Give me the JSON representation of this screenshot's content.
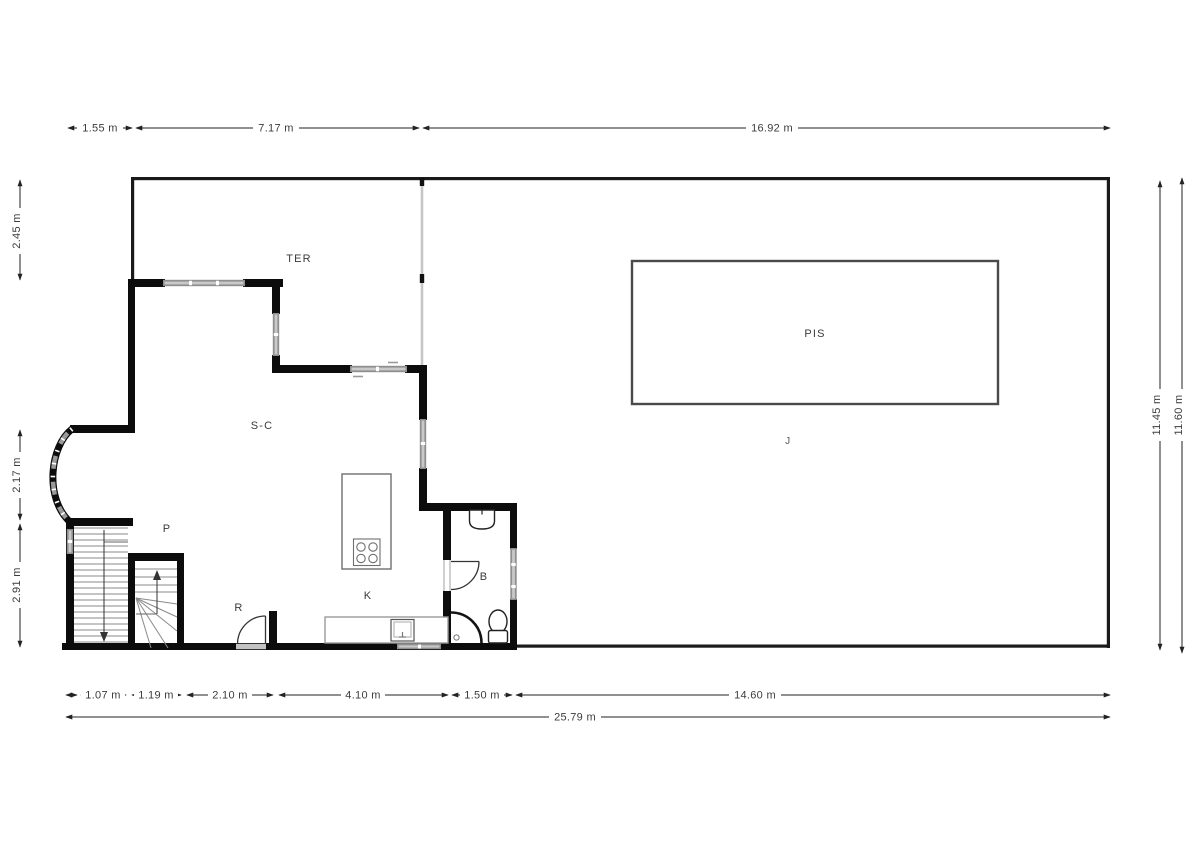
{
  "title": "Floor plan",
  "rooms": {
    "ter": "TER",
    "pis": "PIS",
    "j": "J",
    "sc": "S-C",
    "p": "P",
    "r": "R",
    "k": "K",
    "b": "B"
  },
  "dimensions": {
    "top": [
      "1.55 m",
      "7.17 m",
      "16.92 m"
    ],
    "left": [
      "2.45 m",
      "2.17 m",
      "2.91 m"
    ],
    "right": [
      "11.45 m",
      "11.60 m"
    ],
    "bottom": [
      "1.07 m",
      "1.19 m",
      "2.10 m",
      "4.10 m",
      "1.50 m",
      "14.60 m"
    ],
    "bottom_total": "25.79 m"
  },
  "colors": {
    "wall": "#0c0c0c",
    "boundary": "#1a1a1a",
    "window": "#8f8f8f",
    "divider": "#c6c6c6",
    "fixture": "#2a2a2a",
    "dim": "#3c3c3c"
  }
}
